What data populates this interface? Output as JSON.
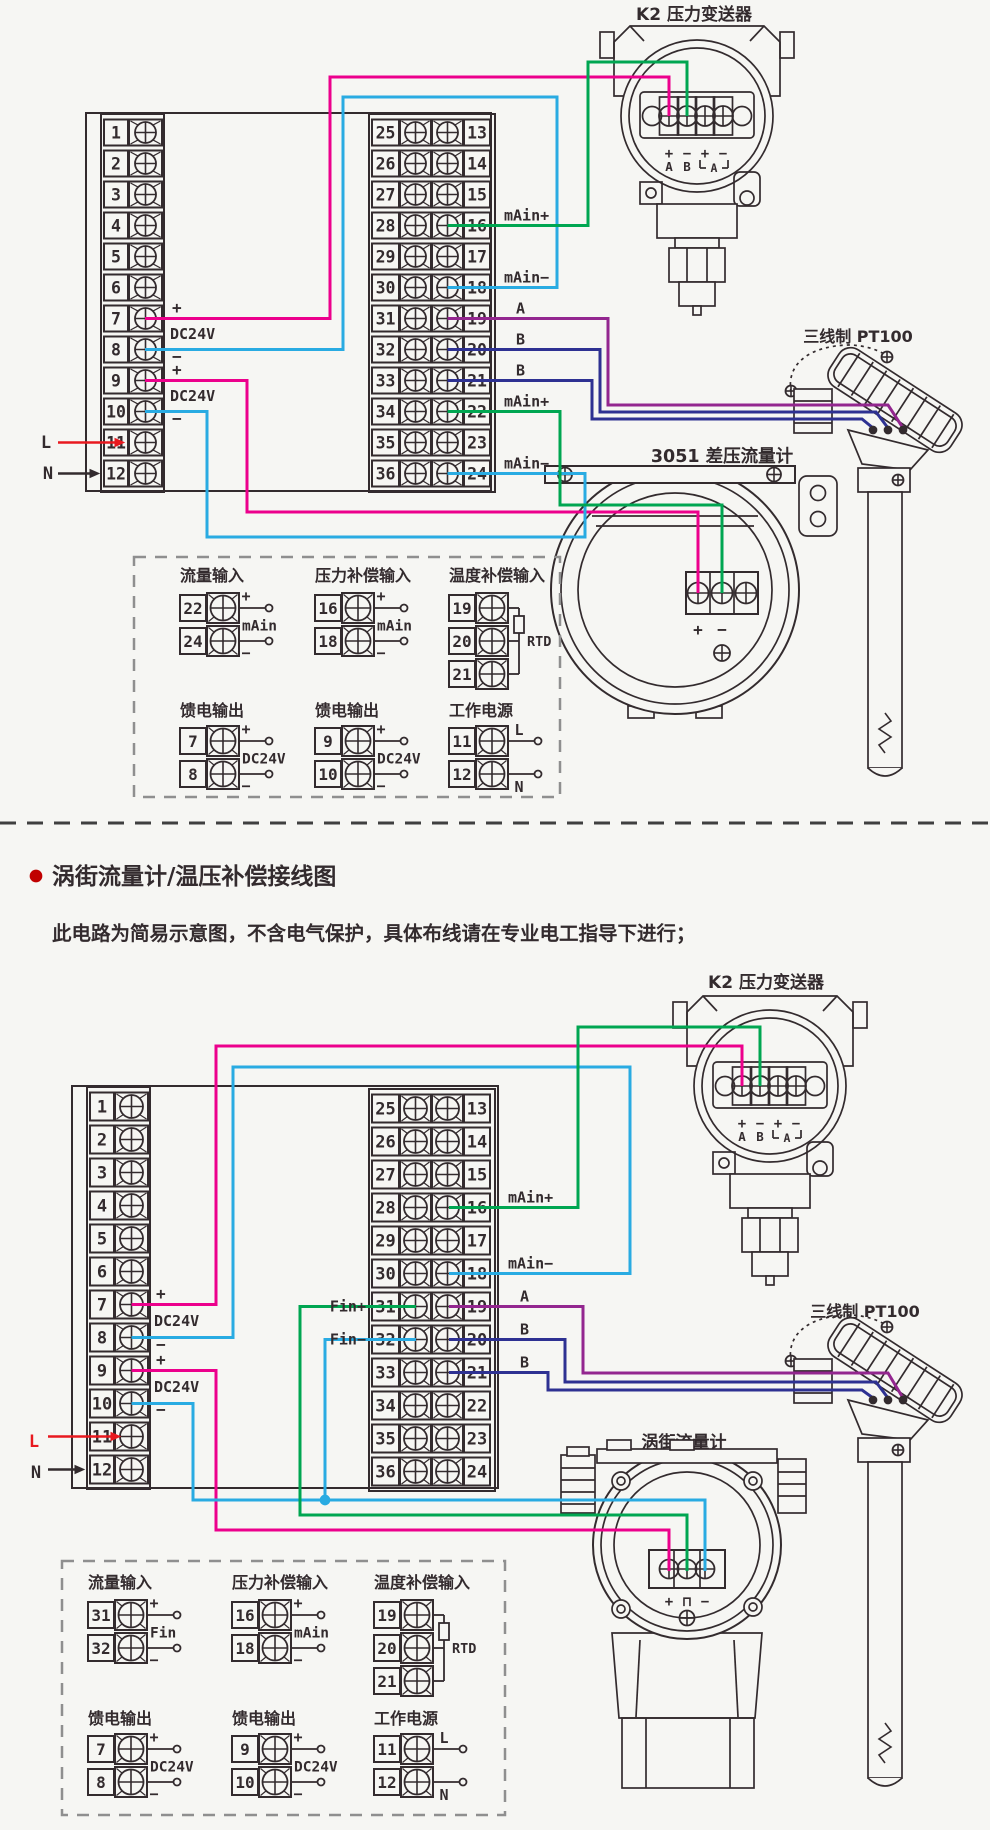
{
  "colors": {
    "pink": "#ec008c",
    "cyan": "#29abe2",
    "green": "#00a651",
    "purple": "#93268f",
    "blue": "#2e3192",
    "red": "#e8191f",
    "ink": "#332b2e",
    "bg": "#f6f6f3",
    "bullet": "#c00000",
    "dash": "#8f8f8f"
  },
  "shared": {
    "left_numbers": [
      "1",
      "2",
      "3",
      "4",
      "5",
      "6",
      "7",
      "8",
      "9",
      "10",
      "11",
      "12"
    ],
    "mid_left_numbers": [
      "25",
      "26",
      "27",
      "28",
      "29",
      "30",
      "31",
      "32",
      "33",
      "34",
      "35",
      "36"
    ],
    "mid_right_numbers": [
      "13",
      "14",
      "15",
      "16",
      "17",
      "18",
      "19",
      "20",
      "21",
      "22",
      "23",
      "24"
    ],
    "psu": {
      "plus": "+",
      "minus": "−",
      "dc": "DC24V"
    },
    "mains": {
      "live": "L",
      "neutral": "N"
    }
  },
  "k2": {
    "label": "K2 压力变送器",
    "signs": [
      "+",
      "−",
      "+",
      "−"
    ],
    "ab": [
      "A",
      "B"
    ],
    "loop": "A"
  },
  "pt100": {
    "label": "三线制 PT100"
  },
  "section1": {
    "meter_label": "3051 差压流量计",
    "meter_signs": [
      "+",
      "−"
    ],
    "right_labels": [
      {
        "row": "16",
        "text": "mAin+"
      },
      {
        "row": "18",
        "text": "mAin−"
      },
      {
        "row": "19",
        "text": "A"
      },
      {
        "row": "20",
        "text": "B"
      },
      {
        "row": "21",
        "text": "B"
      },
      {
        "row": "22",
        "text": "mAin+"
      },
      {
        "row": "24",
        "text": "mAin−"
      }
    ]
  },
  "section2": {
    "title": "涡街流量计/温压补偿接线图",
    "subtitle": "此电路为简易示意图，不含电气保护，具体布线请在专业电工指导下进行；",
    "meter_label": "涡街流量计",
    "meter_signs": [
      "+",
      "⊓",
      "−"
    ],
    "right_labels": [
      {
        "row": "16",
        "text": "mAin+"
      },
      {
        "row": "18",
        "text": "mAin−"
      },
      {
        "row": "19",
        "text": "A"
      },
      {
        "row": "20",
        "text": "B"
      },
      {
        "row": "21",
        "text": "B"
      }
    ],
    "left_labels": [
      {
        "row": "31",
        "text": "Fin+"
      },
      {
        "row": "32",
        "text": "Fin−"
      }
    ]
  },
  "legend1": {
    "groups": [
      {
        "title": "流量输入",
        "type": "pair",
        "rows": [
          {
            "num": "22",
            "sign": "+"
          },
          {
            "num": "24",
            "sign": "−"
          }
        ],
        "mid": "mAin"
      },
      {
        "title": "压力补偿输入",
        "type": "pair",
        "rows": [
          {
            "num": "16",
            "sign": "+"
          },
          {
            "num": "18",
            "sign": "−"
          }
        ],
        "mid": "mAin"
      },
      {
        "title": "温度补偿输入",
        "type": "rtd",
        "rows": [
          {
            "num": "19"
          },
          {
            "num": "20"
          },
          {
            "num": "21"
          }
        ],
        "side": "RTD"
      },
      {
        "title": "馈电输出",
        "type": "pair",
        "rows": [
          {
            "num": "7",
            "sign": "+"
          },
          {
            "num": "8",
            "sign": "−"
          }
        ],
        "mid": "DC24V"
      },
      {
        "title": "馈电输出",
        "type": "pair",
        "rows": [
          {
            "num": "9",
            "sign": "+"
          },
          {
            "num": "10",
            "sign": "−"
          }
        ],
        "mid": "DC24V"
      },
      {
        "title": "工作电源",
        "type": "power",
        "rows": [
          {
            "num": "11",
            "sign": "L"
          },
          {
            "num": "12",
            "sign": "N"
          }
        ]
      }
    ]
  },
  "legend2": {
    "groups": [
      {
        "title": "流量输入",
        "type": "pair",
        "rows": [
          {
            "num": "31",
            "sign": "+"
          },
          {
            "num": "32",
            "sign": "−"
          }
        ],
        "mid": "Fin"
      },
      {
        "title": "压力补偿输入",
        "type": "pair",
        "rows": [
          {
            "num": "16",
            "sign": "+"
          },
          {
            "num": "18",
            "sign": "−"
          }
        ],
        "mid": "mAin"
      },
      {
        "title": "温度补偿输入",
        "type": "rtd",
        "rows": [
          {
            "num": "19"
          },
          {
            "num": "20"
          },
          {
            "num": "21"
          }
        ],
        "side": "RTD"
      },
      {
        "title": "馈电输出",
        "type": "pair",
        "rows": [
          {
            "num": "7",
            "sign": "+"
          },
          {
            "num": "8",
            "sign": "−"
          }
        ],
        "mid": "DC24V"
      },
      {
        "title": "馈电输出",
        "type": "pair",
        "rows": [
          {
            "num": "9",
            "sign": "+"
          },
          {
            "num": "10",
            "sign": "−"
          }
        ],
        "mid": "DC24V"
      },
      {
        "title": "工作电源",
        "type": "power",
        "rows": [
          {
            "num": "11",
            "sign": "L"
          },
          {
            "num": "12",
            "sign": "N"
          }
        ]
      }
    ]
  }
}
